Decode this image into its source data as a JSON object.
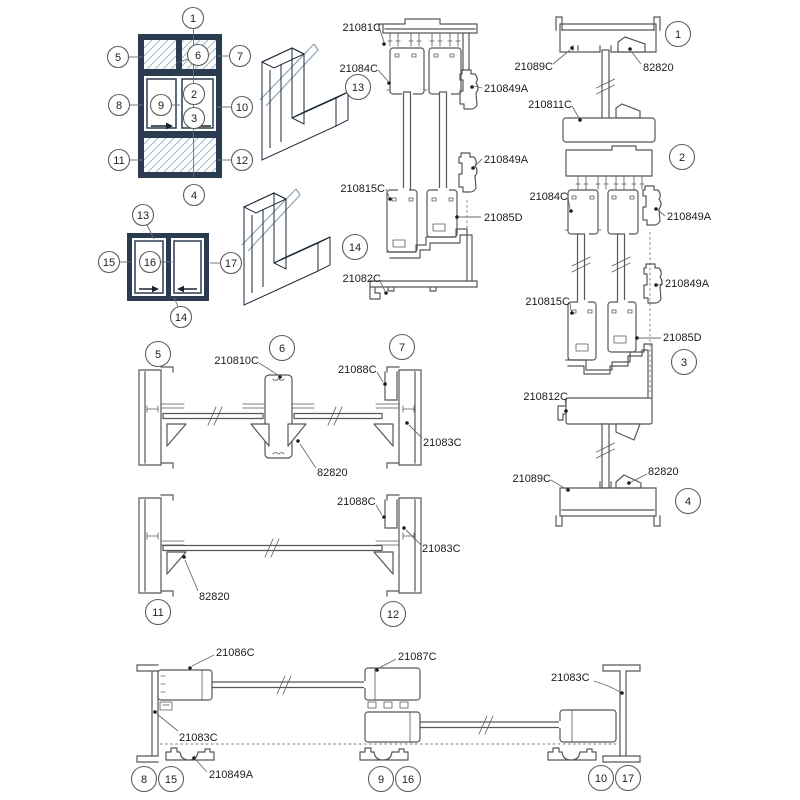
{
  "meta": {
    "description": "Aluminium sliding-window system drawing: two window elevations with numbered callouts, two 3D corner profile samples, and profile cross-section details with part numbers"
  },
  "colors": {
    "line": "#575757",
    "label_text": "#1b1b1b",
    "frame_navy": "#2c3c50",
    "frame_navy_dark": "#1c2938",
    "frame_navy_light": "#4a5f77",
    "glass_hatch": "#a9b9c4",
    "background": "#ffffff"
  },
  "callouts": {
    "c1": "1",
    "c2": "2",
    "c3": "3",
    "c4": "4",
    "c5": "5",
    "c6": "6",
    "c7": "7",
    "c8": "8",
    "c9": "9",
    "c10": "10",
    "c11": "11",
    "c12": "12",
    "c13": "13",
    "c14": "14",
    "c15": "15",
    "c16": "16",
    "c17": "17"
  },
  "parts": {
    "p21081C": "21081C",
    "p21082C": "21082C",
    "p21083C": "21083C",
    "p21084C": "21084C",
    "p21085D": "21085D",
    "p21086C": "21086C",
    "p21087C": "21087C",
    "p21088C": "21088C",
    "p21089C": "21089C",
    "p210810C": "210810C",
    "p210811C": "210811C",
    "p210812C": "210812C",
    "p210815C": "210815C",
    "p210849A": "210849A",
    "p82820": "82820"
  },
  "sections": {
    "elevation_main": {
      "callouts": [
        "1",
        "2",
        "3",
        "4",
        "5",
        "6",
        "7",
        "8",
        "9",
        "10",
        "11",
        "12"
      ]
    },
    "elevation_two_panel": {
      "callouts": [
        "13",
        "14",
        "15",
        "16",
        "17"
      ]
    },
    "head_sill_section": {
      "callouts": [
        "13",
        "14"
      ],
      "parts": [
        "21081C",
        "21084C",
        "210849A",
        "210849A",
        "210815C",
        "21085D",
        "21082C"
      ]
    },
    "full_vertical_section": {
      "callouts": [
        "1",
        "2",
        "3",
        "4"
      ],
      "parts": [
        "21089C",
        "82820",
        "210811C",
        "21084C",
        "210849A",
        "210849A",
        "210815C",
        "21085D",
        "210812C",
        "21089C",
        "82820"
      ]
    },
    "top_horizontal_section": {
      "callouts": [
        "5",
        "6",
        "7"
      ],
      "parts": [
        "210810C",
        "21088C",
        "21083C",
        "82820"
      ]
    },
    "mid_horizontal_section": {
      "callouts": [
        "11",
        "12"
      ],
      "parts": [
        "21088C",
        "21083C",
        "82820"
      ]
    },
    "bottom_horizontal_section": {
      "callouts": [
        "8",
        "15",
        "9",
        "16",
        "10",
        "17"
      ],
      "parts": [
        "21086C",
        "21087C",
        "21083C",
        "210849A",
        "21083C"
      ]
    }
  }
}
